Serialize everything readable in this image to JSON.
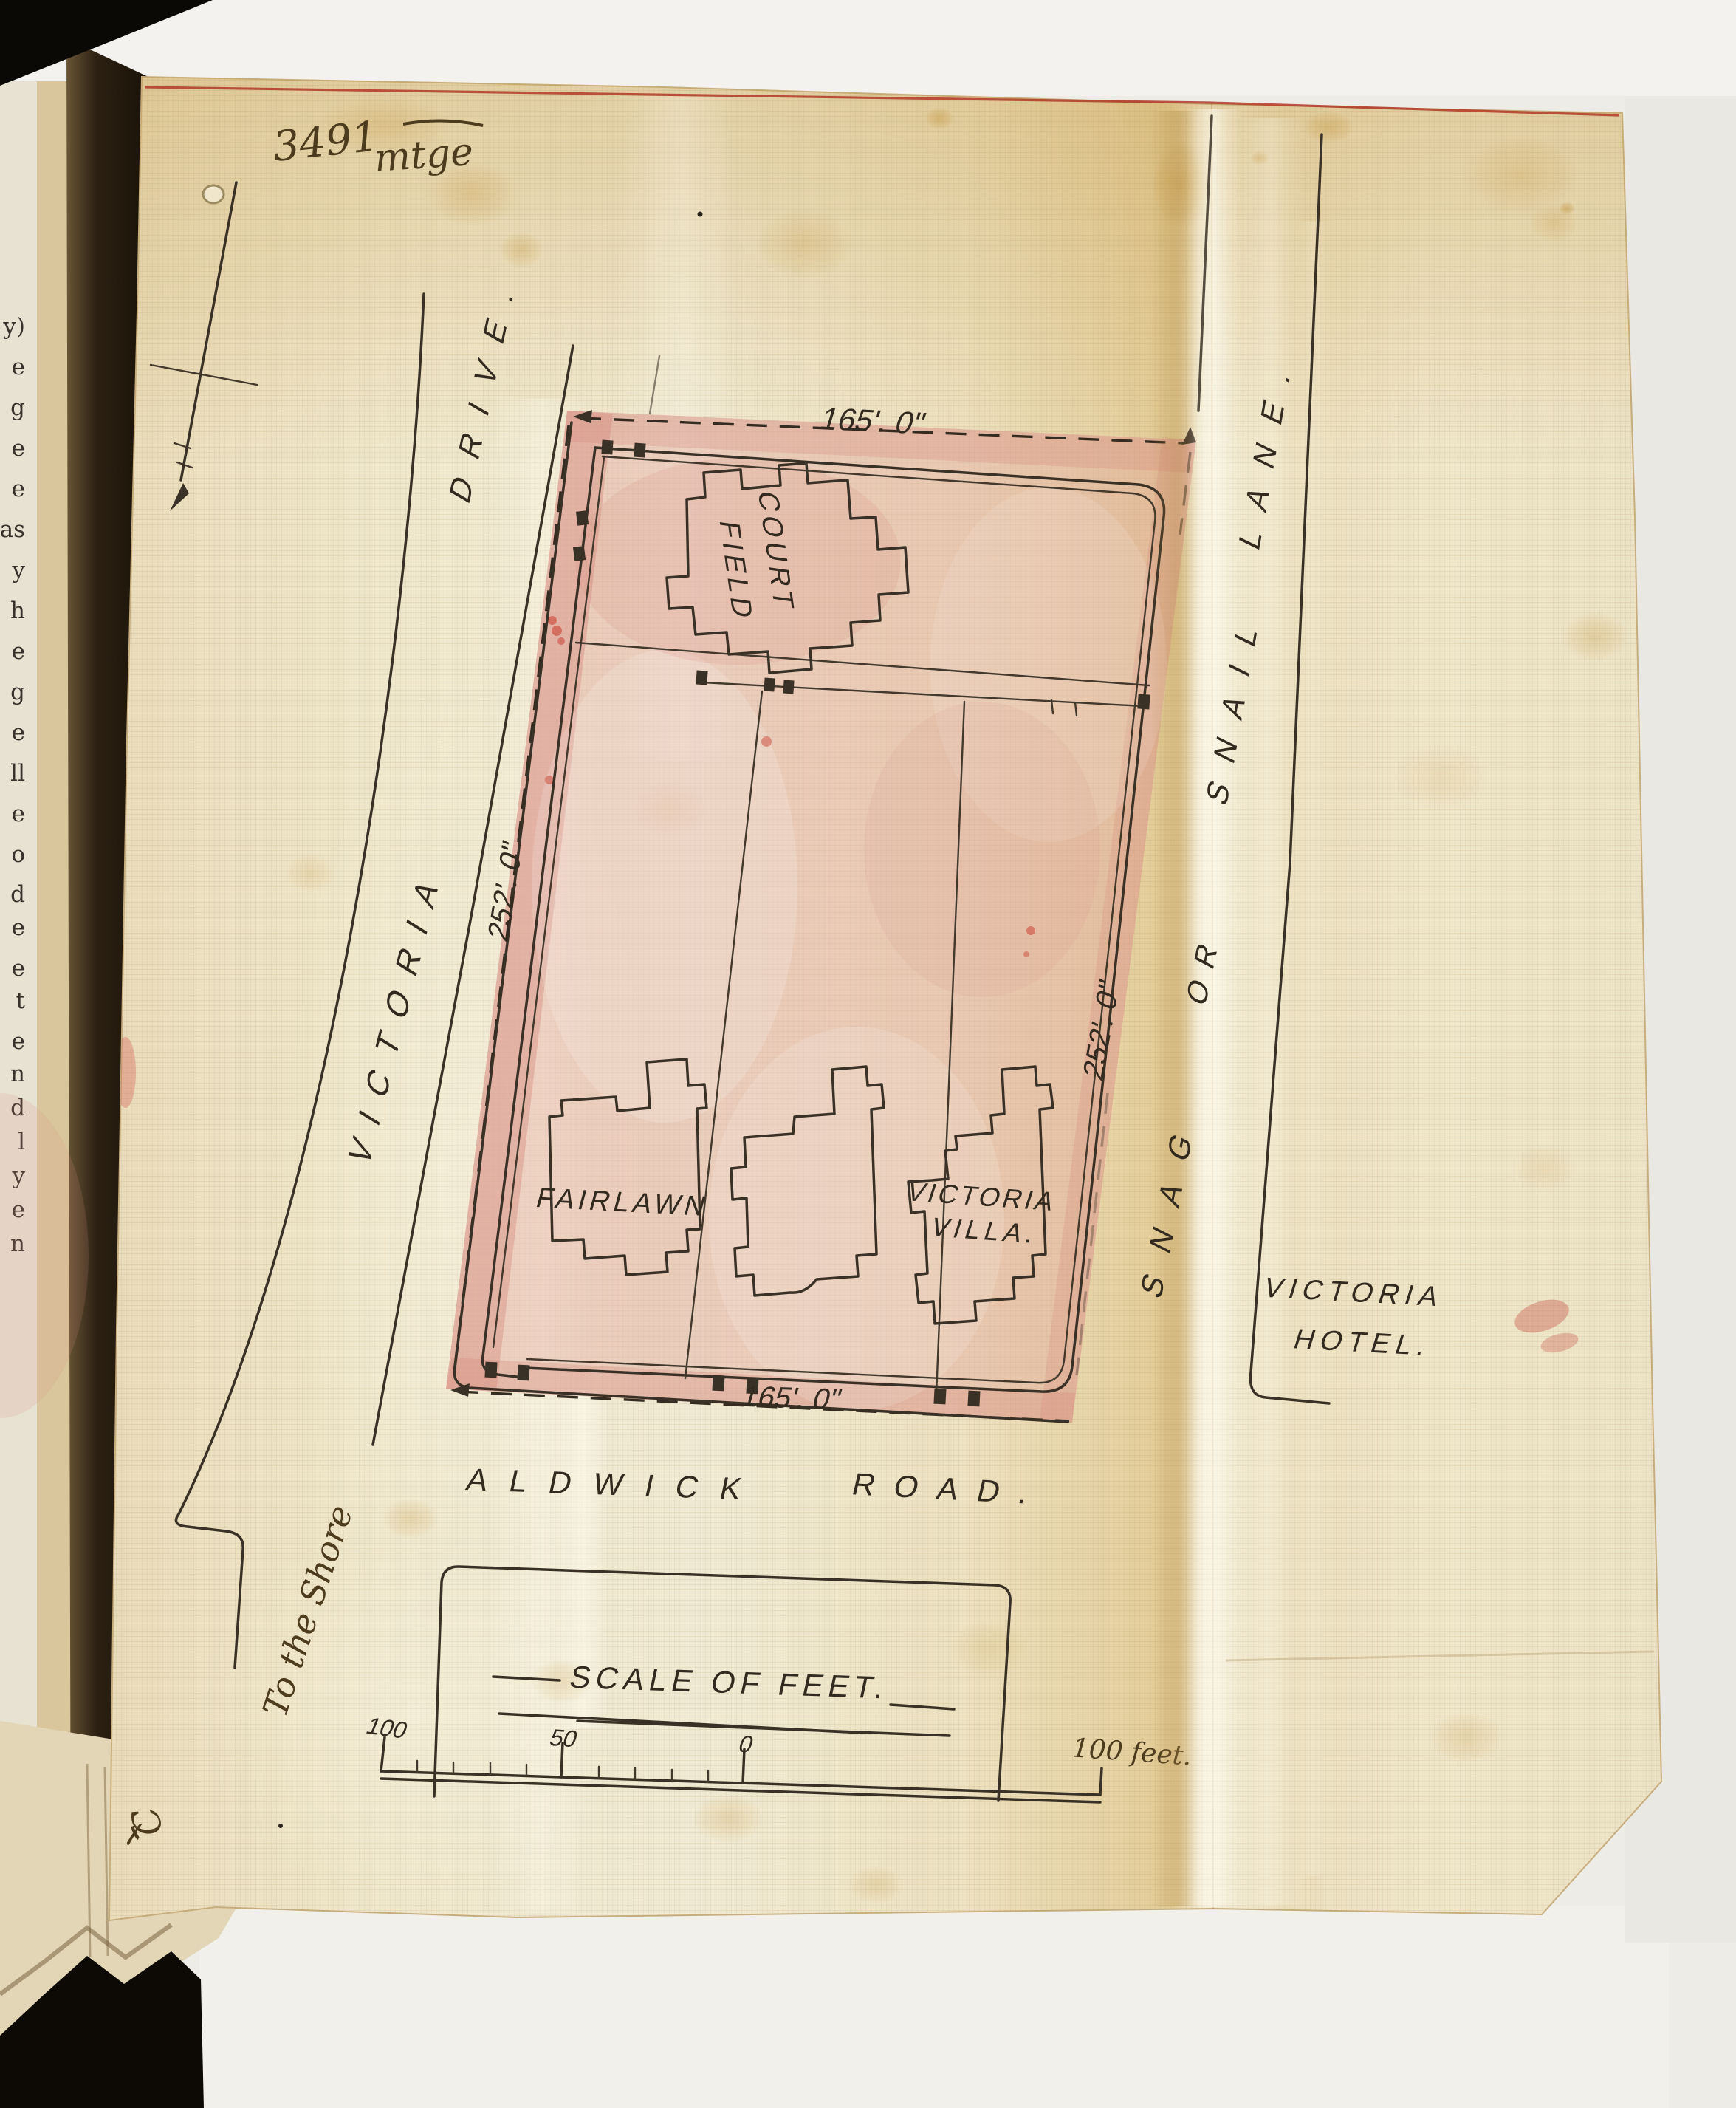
{
  "document": {
    "type": "site-plan",
    "annotations": {
      "file_number": "3491",
      "file_word": "mtge",
      "corner_mark_letter": "C",
      "corner_mark_cross": "✗",
      "to_the_shore": "To the Shore"
    },
    "plot": {
      "dimensions": {
        "top": "165'. 0\"",
        "bottom": "165'. 0\"",
        "left": "252'. 0\"",
        "right": "252'. 0\""
      },
      "buildings": {
        "court_field": [
          "COURT",
          "FIELD"
        ],
        "fairlawn": "FAIRLAWN",
        "victoria_villa": [
          "VICTORIA",
          "VILLA."
        ]
      }
    },
    "roads": {
      "victoria_drive": [
        "VICTORIA",
        "DRIVE."
      ],
      "aldwick_road": [
        "ALDWICK",
        "ROAD."
      ],
      "snag_or_snail_lane": [
        "SNAG",
        "OR",
        "SNAIL",
        "LANE."
      ],
      "victoria_hotel": [
        "VICTORIA",
        "HOTEL."
      ]
    },
    "scale_bar": {
      "title": "SCALE OF FEET.",
      "label_100": "100",
      "label_50": "50",
      "label_0": "0",
      "label_right": "100 feet."
    },
    "page_edge_letters": [
      "y)",
      "e",
      "g",
      "e",
      "e",
      "as",
      "y",
      "h",
      "e",
      "g",
      "e",
      "ll",
      "e",
      "o",
      "d",
      "e",
      "e",
      "t",
      "e",
      "n",
      "d",
      "l",
      "y",
      "e",
      "n"
    ],
    "colors": {
      "paper": "#ece0c0",
      "paper_gold": "#e3cc97",
      "pink_wash": "#e2a89e",
      "ink": "#3a3126",
      "red_margin_line": "#b23a28",
      "backdrop": "#edece7",
      "book_void": "#0d0a06"
    }
  }
}
